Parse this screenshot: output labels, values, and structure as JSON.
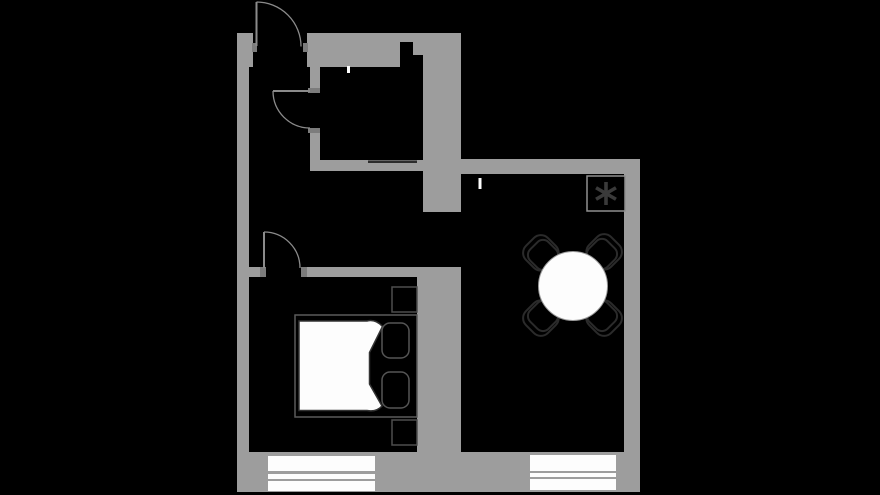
{
  "canvas": {
    "width": 880,
    "height": 495,
    "background": "#000000"
  },
  "palette": {
    "wall": "#9d9d9d",
    "wall_jamb": "#7c7c7c",
    "door_stroke": "#8b8b8b",
    "outline_dark": "#2b2b2b",
    "outline_mid": "#555555",
    "frame_stroke": "#5a5a5a",
    "nightstand_stroke": "#4e4e4e",
    "duvet_stroke": "#333333",
    "box_outline": "#8f8f8f",
    "accent_dark": "#2c2c2c",
    "white": "#fdfdfd",
    "table_edge": "#999999",
    "asterisk": "#3a3a3a"
  },
  "walls": [
    {
      "name": "left-wall-top",
      "x": 237,
      "y": 33,
      "w": 16,
      "h": 34
    },
    {
      "name": "left-wall",
      "x": 237,
      "y": 67,
      "w": 12,
      "h": 425
    },
    {
      "name": "top-wall",
      "x": 307,
      "y": 33,
      "w": 93,
      "h": 34
    },
    {
      "name": "top-wall-step-a",
      "x": 400,
      "y": 33,
      "w": 13,
      "h": 9
    },
    {
      "name": "top-wall-step-b",
      "x": 413,
      "y": 33,
      "w": 12,
      "h": 22
    },
    {
      "name": "core-wall-upper",
      "x": 423,
      "y": 33,
      "w": 38,
      "h": 179
    },
    {
      "name": "bathroom-wall-upper",
      "x": 310,
      "y": 67,
      "w": 10,
      "h": 21
    },
    {
      "name": "bathroom-wall-lower",
      "x": 310,
      "y": 133,
      "w": 10,
      "h": 27
    },
    {
      "name": "bathroom-bottom-wall",
      "x": 310,
      "y": 160,
      "w": 113,
      "h": 11
    },
    {
      "name": "living-top-wall",
      "x": 461,
      "y": 159,
      "w": 179,
      "h": 15
    },
    {
      "name": "right-wall",
      "x": 624,
      "y": 159,
      "w": 16,
      "h": 333
    },
    {
      "name": "bedroom-top-wall-left",
      "x": 249,
      "y": 267,
      "w": 12,
      "h": 10
    },
    {
      "name": "bedroom-top-wall",
      "x": 307,
      "y": 267,
      "w": 154,
      "h": 10
    },
    {
      "name": "mid-wall",
      "x": 417,
      "y": 267,
      "w": 44,
      "h": 225
    },
    {
      "name": "bottom-wall",
      "x": 237,
      "y": 452,
      "w": 403,
      "h": 40
    }
  ],
  "jambs": [
    {
      "name": "entrance-jamb-left",
      "x": 252,
      "y": 43,
      "w": 5,
      "h": 9
    },
    {
      "name": "entrance-jamb-right",
      "x": 303,
      "y": 43,
      "w": 5,
      "h": 9
    },
    {
      "name": "bathroom-jamb-top",
      "x": 308,
      "y": 88,
      "w": 12,
      "h": 5
    },
    {
      "name": "bathroom-jamb-bottom",
      "x": 308,
      "y": 128,
      "w": 12,
      "h": 5
    },
    {
      "name": "bedroom-jamb-left",
      "x": 260,
      "y": 267,
      "w": 6,
      "h": 10
    },
    {
      "name": "bedroom-jamb-right",
      "x": 301,
      "y": 267,
      "w": 6,
      "h": 10
    }
  ],
  "accents": [
    {
      "name": "bathroom-counter-line",
      "x": 368,
      "y": 160.5,
      "w": 49,
      "h": 2.5
    }
  ],
  "ticks": [
    {
      "name": "bathroom-wall-tick",
      "x": 347,
      "y": 66,
      "w": 3,
      "h": 7
    },
    {
      "name": "livingroom-wall-tick",
      "x": 478.5,
      "y": 178,
      "w": 3,
      "h": 11
    }
  ],
  "doors": [
    {
      "name": "entrance-door",
      "leaf": [
        256.5,
        2,
        256.5,
        46
      ],
      "arc": "M 256.5,2 A 44.5,44.5 0 0 1 301,46.5"
    },
    {
      "name": "bathroom-door",
      "leaf": [
        273,
        91,
        310,
        91
      ],
      "arc": "M 273,91 A 37,37 0 0 0 310,128"
    },
    {
      "name": "bedroom-door",
      "leaf": [
        264,
        232,
        264,
        268
      ],
      "arc": "M 264,232 A 36,36 0 0 1 300,268"
    }
  ],
  "windows": [
    {
      "name": "bedroom-window",
      "x": 268,
      "w": 107,
      "bands": [
        {
          "y": 456,
          "h": 15
        },
        {
          "y": 474,
          "h": 5
        },
        {
          "y": 481,
          "h": 10
        }
      ]
    },
    {
      "name": "livingroom-window",
      "x": 530,
      "w": 86,
      "bands": [
        {
          "y": 455,
          "h": 16
        },
        {
          "y": 473,
          "h": 4
        },
        {
          "y": 479,
          "h": 11
        }
      ]
    }
  ],
  "furniture": {
    "bed_frame": {
      "x": 295,
      "y": 315,
      "w": 122,
      "h": 102
    },
    "duvet_path": "M 299,321 L 367,321 C 373,319.5 378,321.5 382.5,326.5 L 369.5,352.5 L 369.5,384 L 382,406 C 378,410.5 372.5,411.5 367,410.5 L 299,410.5 Z",
    "pillows": [
      {
        "x": 382,
        "y": 323,
        "w": 27,
        "h": 35
      },
      {
        "x": 382,
        "y": 372,
        "w": 27,
        "h": 36
      }
    ],
    "nightstands": [
      {
        "x": 392,
        "y": 287,
        "w": 25,
        "h": 25
      },
      {
        "x": 392,
        "y": 420,
        "w": 25,
        "h": 25
      }
    ],
    "table": {
      "cx": 573,
      "cy": 286,
      "r": 34.5
    },
    "chairs": [
      {
        "cx": 543,
        "cy": 255,
        "bdx": -3,
        "bdy": 0
      },
      {
        "cx": 602,
        "cy": 254,
        "bdx": 0,
        "bdy": -3
      },
      {
        "cx": 602,
        "cy": 316,
        "bdx": 3,
        "bdy": 0
      },
      {
        "cx": 543,
        "cy": 316,
        "bdx": 0,
        "bdy": 3
      }
    ],
    "appliance": {
      "x": 587,
      "y": 176,
      "w": 38,
      "h": 35,
      "symbol": "asterisk",
      "cx": 606,
      "cy": 193.5,
      "arm": 11.5,
      "arm_width": 3.6
    }
  }
}
